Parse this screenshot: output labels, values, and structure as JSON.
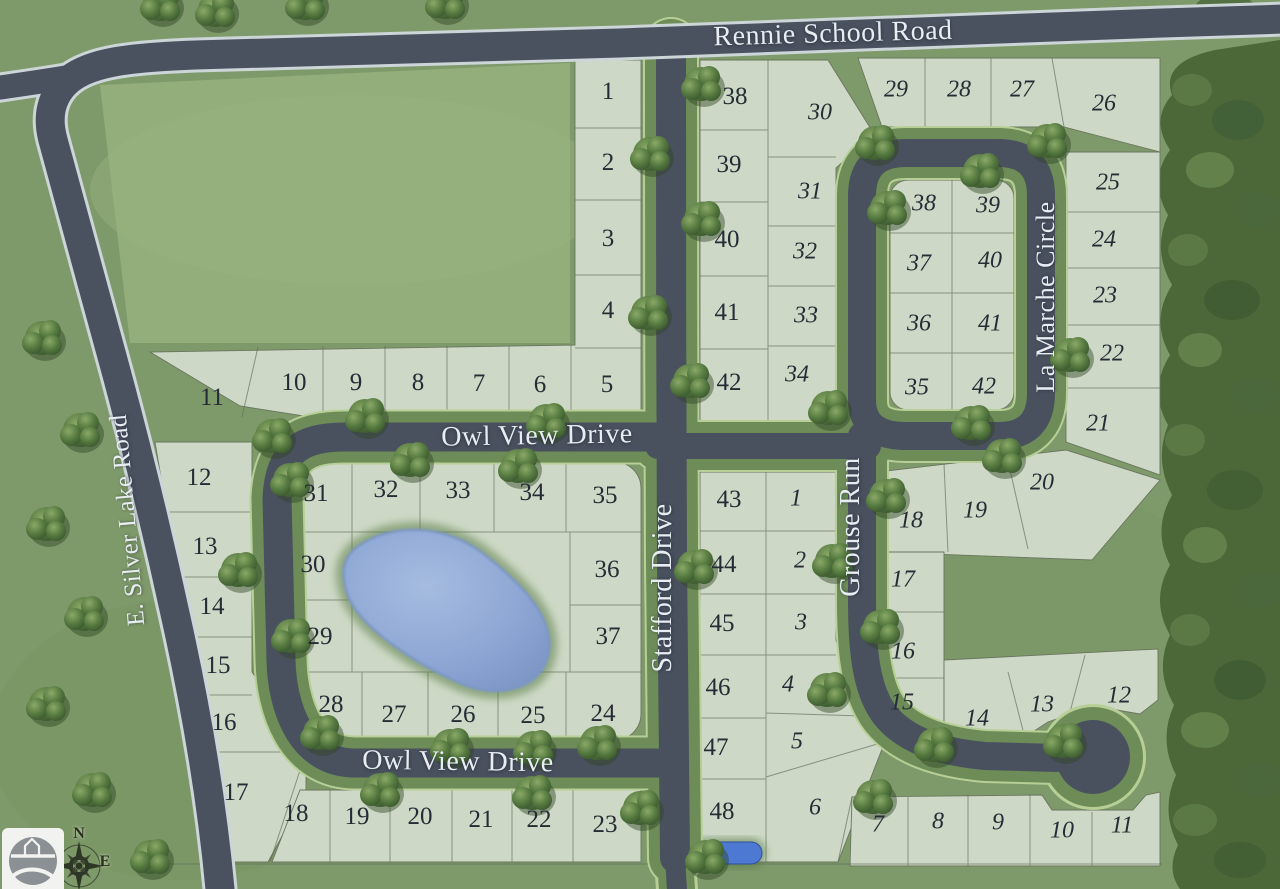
{
  "roads": {
    "rennie": "Rennie School Road",
    "silver_lake": "E. Silver Lake Road",
    "owl_view": "Owl View Drive",
    "stafford": "Stafford Drive",
    "grouse": "Grouse Run",
    "la_marche": "La Marche Circle"
  },
  "compass": {
    "north": "N",
    "east": "E"
  },
  "lots": {
    "phase1": [
      [
        1,
        608,
        92
      ],
      [
        2,
        608,
        163
      ],
      [
        3,
        608,
        239
      ],
      [
        4,
        608,
        311
      ],
      [
        5,
        607,
        385
      ],
      [
        6,
        540,
        385
      ],
      [
        7,
        479,
        384
      ],
      [
        8,
        418,
        383
      ],
      [
        9,
        356,
        383
      ],
      [
        10,
        294,
        383
      ],
      [
        11,
        212,
        398
      ],
      [
        12,
        199,
        478
      ],
      [
        13,
        205,
        547
      ],
      [
        14,
        212,
        607
      ],
      [
        15,
        218,
        666
      ],
      [
        16,
        224,
        723
      ],
      [
        17,
        236,
        793
      ],
      [
        18,
        296,
        814
      ],
      [
        19,
        357,
        817
      ],
      [
        20,
        420,
        817
      ],
      [
        21,
        481,
        820
      ],
      [
        22,
        539,
        820
      ],
      [
        23,
        605,
        825
      ],
      [
        24,
        603,
        714
      ],
      [
        25,
        533,
        716
      ],
      [
        26,
        463,
        715
      ],
      [
        27,
        394,
        715
      ],
      [
        28,
        331,
        705
      ],
      [
        29,
        320,
        637
      ],
      [
        30,
        313,
        565
      ],
      [
        31,
        316,
        494
      ],
      [
        32,
        386,
        490
      ],
      [
        33,
        458,
        491
      ],
      [
        34,
        532,
        493
      ],
      [
        35,
        605,
        496
      ],
      [
        36,
        607,
        570
      ],
      [
        37,
        608,
        637
      ],
      [
        38,
        735,
        97
      ],
      [
        39,
        729,
        165
      ],
      [
        40,
        727,
        240
      ],
      [
        41,
        727,
        313
      ],
      [
        42,
        729,
        383
      ],
      [
        43,
        729,
        500
      ],
      [
        44,
        724,
        565
      ],
      [
        45,
        722,
        624
      ],
      [
        46,
        718,
        688
      ],
      [
        47,
        716,
        748
      ],
      [
        48,
        722,
        812
      ]
    ],
    "phase2": [
      [
        1,
        796,
        499
      ],
      [
        2,
        800,
        561
      ],
      [
        3,
        801,
        623
      ],
      [
        4,
        788,
        685
      ],
      [
        5,
        797,
        742
      ],
      [
        6,
        815,
        808
      ],
      [
        7,
        878,
        825
      ],
      [
        8,
        938,
        822
      ],
      [
        9,
        998,
        823
      ],
      [
        10,
        1062,
        831
      ],
      [
        11,
        1122,
        826
      ],
      [
        12,
        1119,
        696
      ],
      [
        13,
        1042,
        705
      ],
      [
        14,
        977,
        719
      ],
      [
        15,
        902,
        703
      ],
      [
        16,
        903,
        652
      ],
      [
        17,
        903,
        580
      ],
      [
        18,
        911,
        521
      ],
      [
        19,
        975,
        511
      ],
      [
        20,
        1042,
        483
      ],
      [
        21,
        1098,
        424
      ],
      [
        22,
        1112,
        354
      ],
      [
        23,
        1105,
        296
      ],
      [
        24,
        1104,
        240
      ],
      [
        25,
        1108,
        183
      ],
      [
        26,
        1104,
        104
      ],
      [
        27,
        1022,
        90
      ],
      [
        28,
        959,
        90
      ],
      [
        29,
        896,
        90
      ],
      [
        30,
        820,
        113
      ],
      [
        31,
        810,
        192
      ],
      [
        32,
        805,
        252
      ],
      [
        33,
        806,
        316
      ],
      [
        34,
        797,
        375
      ],
      [
        35,
        917,
        388
      ],
      [
        36,
        919,
        324
      ],
      [
        37,
        919,
        264
      ],
      [
        38,
        924,
        204
      ],
      [
        39,
        988,
        206
      ],
      [
        40,
        990,
        261
      ],
      [
        41,
        990,
        324
      ],
      [
        42,
        984,
        387
      ]
    ]
  }
}
